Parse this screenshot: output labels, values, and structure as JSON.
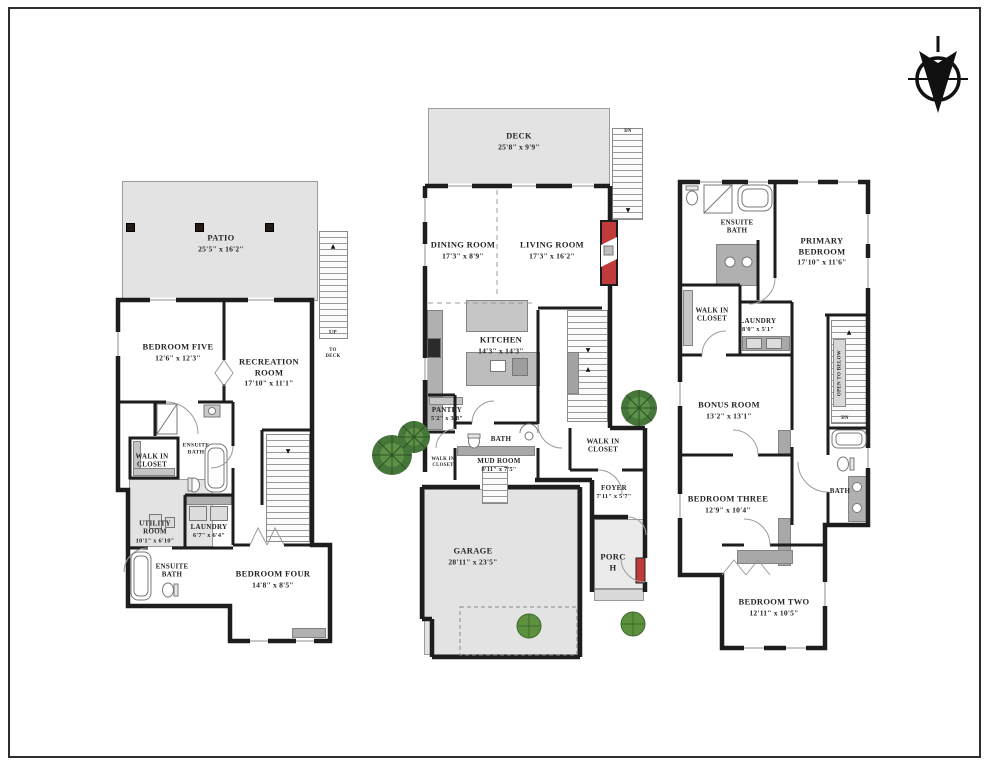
{
  "colors": {
    "wall": "#1d1d1d",
    "floor_gray": "#e3e3e3",
    "counter_gray": "#b0b0b0",
    "accent_red": "#c23b3b",
    "tree_green": "#3f7a33",
    "stair_gray": "#9a9a9a"
  },
  "icons": {
    "compass": "north-arrow-icon",
    "up_arrow": "▲",
    "down_arrow": "▼"
  },
  "plans": {
    "basement": {
      "rooms": [
        {
          "name": "PATIO",
          "dims": "25'5\" x 16'2\""
        },
        {
          "name": "BEDROOM FIVE",
          "dims": "12'6\" x 12'3\""
        },
        {
          "name": "RECREATION ROOM",
          "dims": "17'10\" x 11'1\""
        },
        {
          "name": "ENSUITE BATH",
          "dims": ""
        },
        {
          "name": "WALK IN CLOSET",
          "dims": ""
        },
        {
          "name": "LAUNDRY",
          "dims": "6'7\" x 6'4\""
        },
        {
          "name": "UTILITY ROOM",
          "dims": "10'1\" x 6'10\""
        },
        {
          "name": "ENSUITE BATH",
          "dims": ""
        },
        {
          "name": "BEDROOM FOUR",
          "dims": "14'8\" x 8'5\""
        }
      ],
      "stairs": {
        "up": "UP",
        "note": "TO DECK"
      }
    },
    "main": {
      "rooms": [
        {
          "name": "DECK",
          "dims": "25'8\" x 9'9\""
        },
        {
          "name": "DINING ROOM",
          "dims": "17'3\" x 8'9\""
        },
        {
          "name": "LIVING ROOM",
          "dims": "17'3\" x 16'2\""
        },
        {
          "name": "KITCHEN",
          "dims": "14'3\" x 14'3\""
        },
        {
          "name": "PANTRY",
          "dims": "5'2\" x 3'8\""
        },
        {
          "name": "BATH",
          "dims": ""
        },
        {
          "name": "MUD ROOM",
          "dims": "8'11\" x 7'5\""
        },
        {
          "name": "WALK IN CLOSET",
          "dims": ""
        },
        {
          "name": "WALK IN CLOSET",
          "dims": ""
        },
        {
          "name": "FOYER",
          "dims": "7'11\" x 5'7\""
        },
        {
          "name": "GARAGE",
          "dims": "28'11\" x 23'5\""
        },
        {
          "name": "PORCH",
          "dims": ""
        }
      ],
      "stairs": {
        "dn": "DN"
      }
    },
    "upper": {
      "rooms": [
        {
          "name": "ENSUITE BATH",
          "dims": ""
        },
        {
          "name": "PRIMARY BEDROOM",
          "dims": "17'10\" x 11'6\""
        },
        {
          "name": "WALK IN CLOSET",
          "dims": ""
        },
        {
          "name": "LAUNDRY",
          "dims": "8'0\" x 5'1\""
        },
        {
          "name": "BONUS ROOM",
          "dims": "13'2\" x 13'1\""
        },
        {
          "name": "BATH",
          "dims": ""
        },
        {
          "name": "BEDROOM THREE",
          "dims": "12'9\" x 10'4\""
        },
        {
          "name": "BEDROOM TWO",
          "dims": "12'11\" x 10'5\""
        }
      ],
      "annotations": {
        "open_to_below": "OPEN TO BELOW",
        "dn": "DN"
      }
    }
  }
}
